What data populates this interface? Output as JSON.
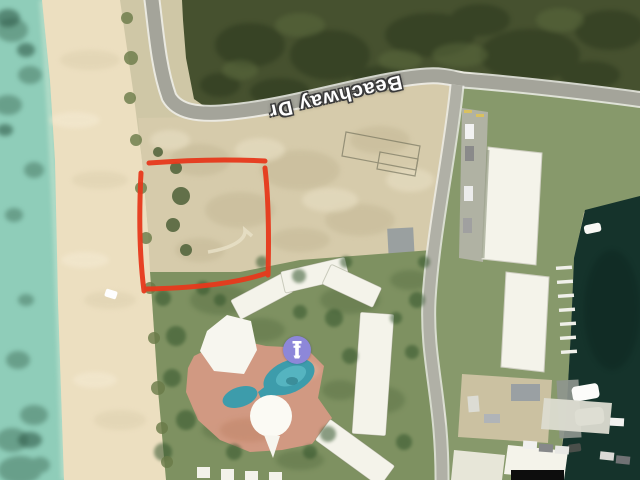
{
  "map": {
    "street_label": "Beachway Dr",
    "marker": {
      "icon": "resort-poi-marker-icon",
      "shape": "purple-circle-with-white-column-glyph"
    },
    "annotation": {
      "type": "hand-drawn-rectangle-outline",
      "purpose": "highlighted vacant beachfront lot",
      "color": "#e7391c"
    },
    "features": {
      "water_left": "shallow turquoise sea with seagrass patches",
      "beach": "sand strip along west shore",
      "lot": "cleared dirt parcel outlined in red",
      "resort": "condo buildings around freeform pool with salmon deck",
      "marina_right": "dark marina water with docks and boats"
    },
    "colors": {
      "sea": "#8fcdb9",
      "sea_dark": "#4a7a65",
      "sand": "#ecdfc0",
      "dirt": "#d6cbab",
      "brush": "#46512f",
      "brush_dark": "#2e3a1f",
      "lawn": "#7e9161",
      "lawn_right": "#87996b",
      "road": "#a4a49a",
      "road_edge": "#eeeeea",
      "roof": "#f4f3ea",
      "deck": "#d69a84",
      "pool": "#3d9cab",
      "pool_light": "#62c1cb",
      "marina": "#15332b",
      "marker": "#8d87d9",
      "annotation": "#e7391c",
      "label_text": "#ffffff",
      "label_outline": "#3a3a3a"
    }
  }
}
